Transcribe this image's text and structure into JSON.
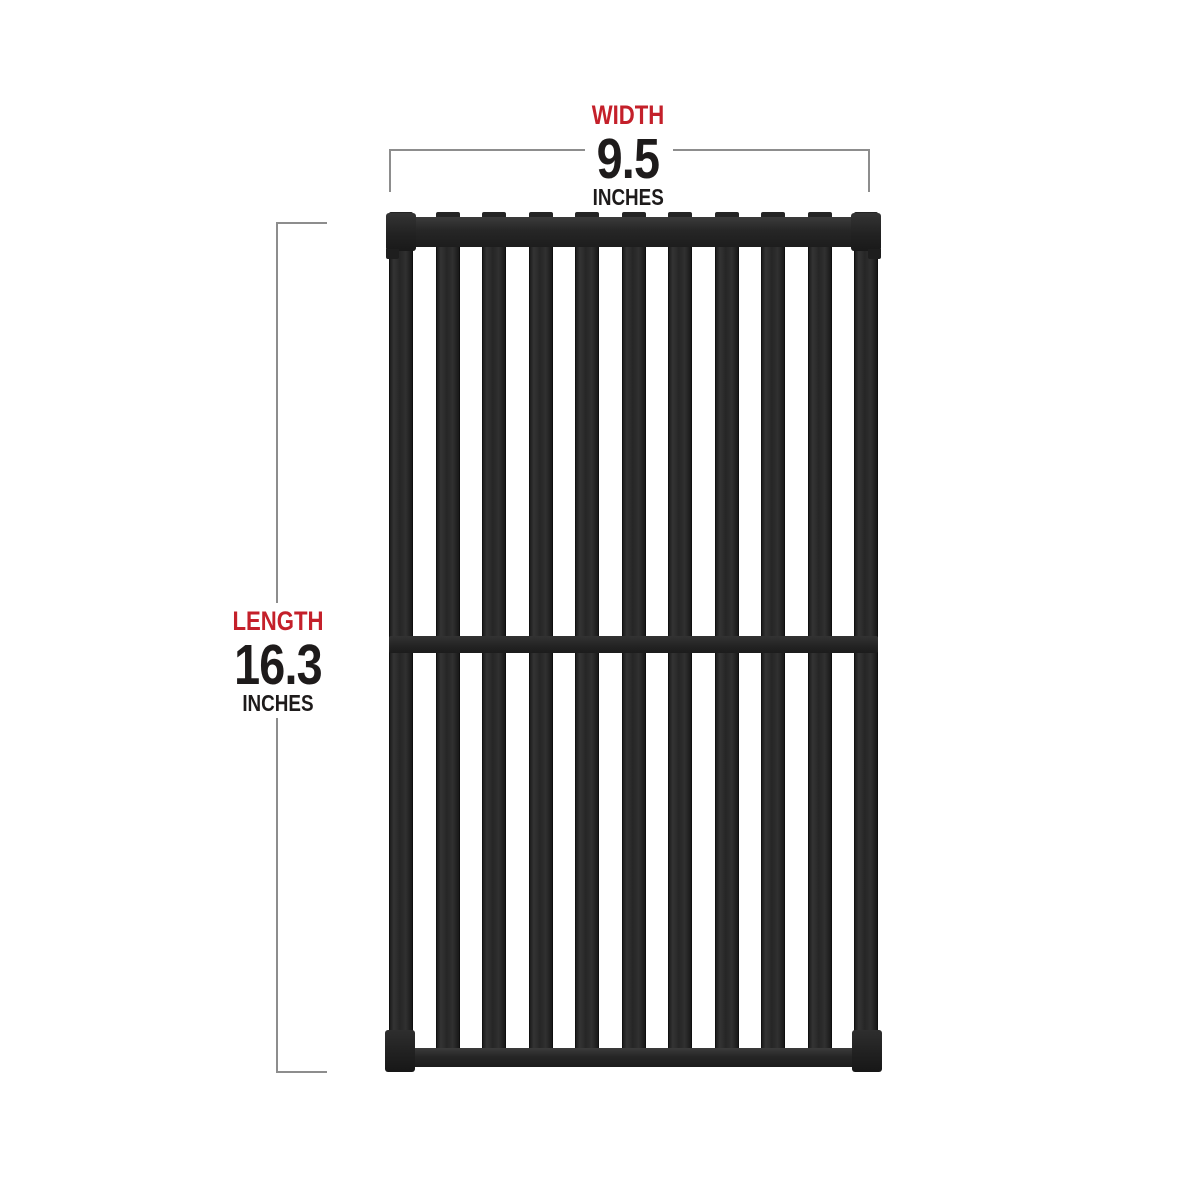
{
  "annotations": {
    "width": {
      "label": "WIDTH",
      "value": "9.5",
      "unit": "INCHES"
    },
    "length": {
      "label": "LENGTH",
      "value": "16.3",
      "unit": "INCHES"
    }
  },
  "colors": {
    "label_red": "#c4202a",
    "value_black": "#1e1b1b",
    "dim_line_gray": "#8d8d8d",
    "grate_black": "#272727",
    "background": "#ffffff"
  },
  "grate": {
    "bar_count": 11,
    "interior_bar_count": 9,
    "rails": [
      "top",
      "middle",
      "bottom"
    ]
  }
}
